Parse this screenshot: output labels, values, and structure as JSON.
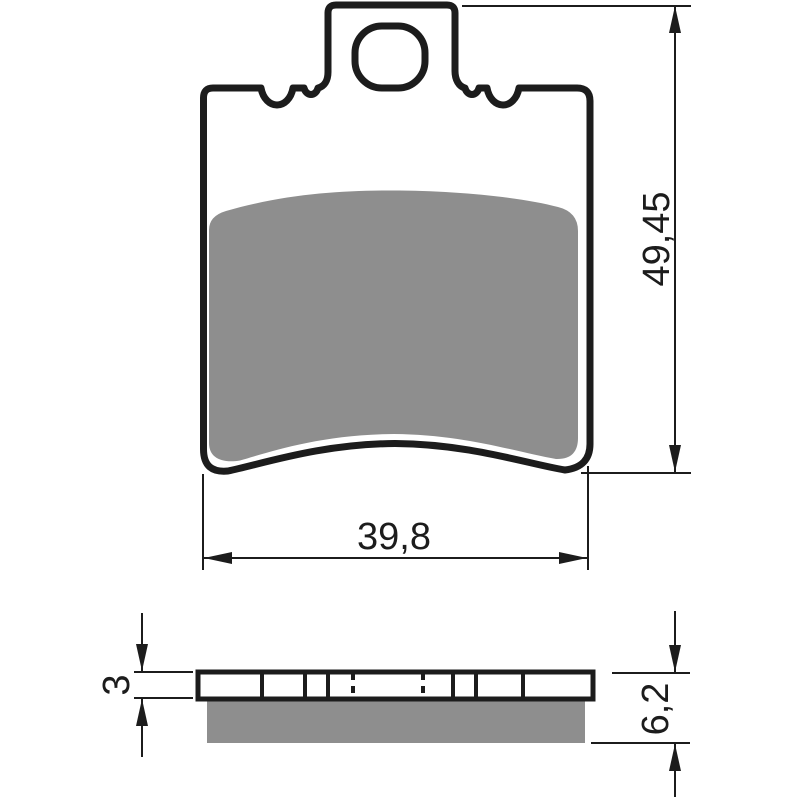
{
  "drawing": {
    "type": "technical-drawing-brake-pad",
    "colors": {
      "line": "#1c1c1c",
      "friction": "#8e8e8e",
      "background": "#ffffff"
    },
    "views": {
      "front": {
        "dim_height_label": "49,45",
        "dim_width_label": "39,8"
      },
      "side": {
        "dim_backplate_label": "3",
        "dim_total_label": "6,2"
      }
    }
  }
}
